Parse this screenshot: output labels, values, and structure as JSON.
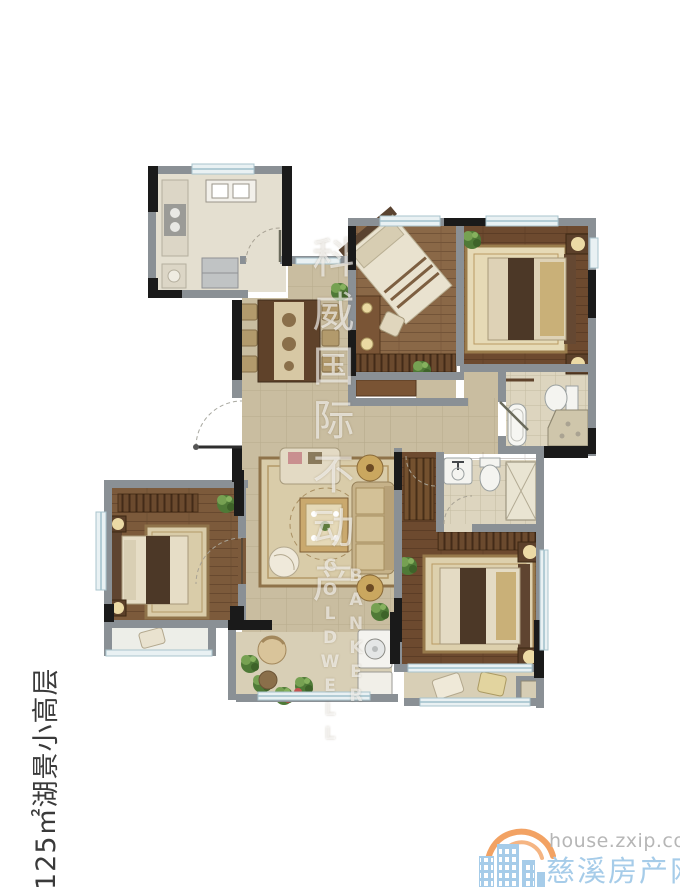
{
  "side_label": {
    "text": "125㎡湖景小高层"
  },
  "watermark": {
    "cn": "科威国际不动产",
    "en_line1": "COLDWELL",
    "en_line2": "BANKER"
  },
  "logo": {
    "url_text": "house.zxip.com",
    "site_name": "慈溪房产网"
  },
  "colors": {
    "wall": "#8a9095",
    "wall_dark": "#1a1a1a",
    "tile": "#c9bda0",
    "tile_line": "#b3a788",
    "wood_light": "#8a6847",
    "wood_dark": "#6d4a2f",
    "wood_master": "#7c5a3b",
    "kitchen_floor": "#e4dfd0",
    "bath_floor": "#ddd5bf",
    "balcony_floor": "#d8cfb6",
    "bay_floor": "#edeee8",
    "window": "#e9f1f3",
    "window_frame": "#a9c4cd",
    "rug": "#dcd0ae",
    "rug_border": "#96794e",
    "furniture_dark": "#4c3827",
    "bed_cream": "#e8e1cd",
    "gold": "#c9b078",
    "plant": "#55803a",
    "logo_blue": "#a6cce9",
    "logo_orange": "#f2a263",
    "logo_gray": "#b6b6b6",
    "label_text": "#3a3a3a",
    "watermark_white": "rgba(255,255,255,0.62)"
  }
}
